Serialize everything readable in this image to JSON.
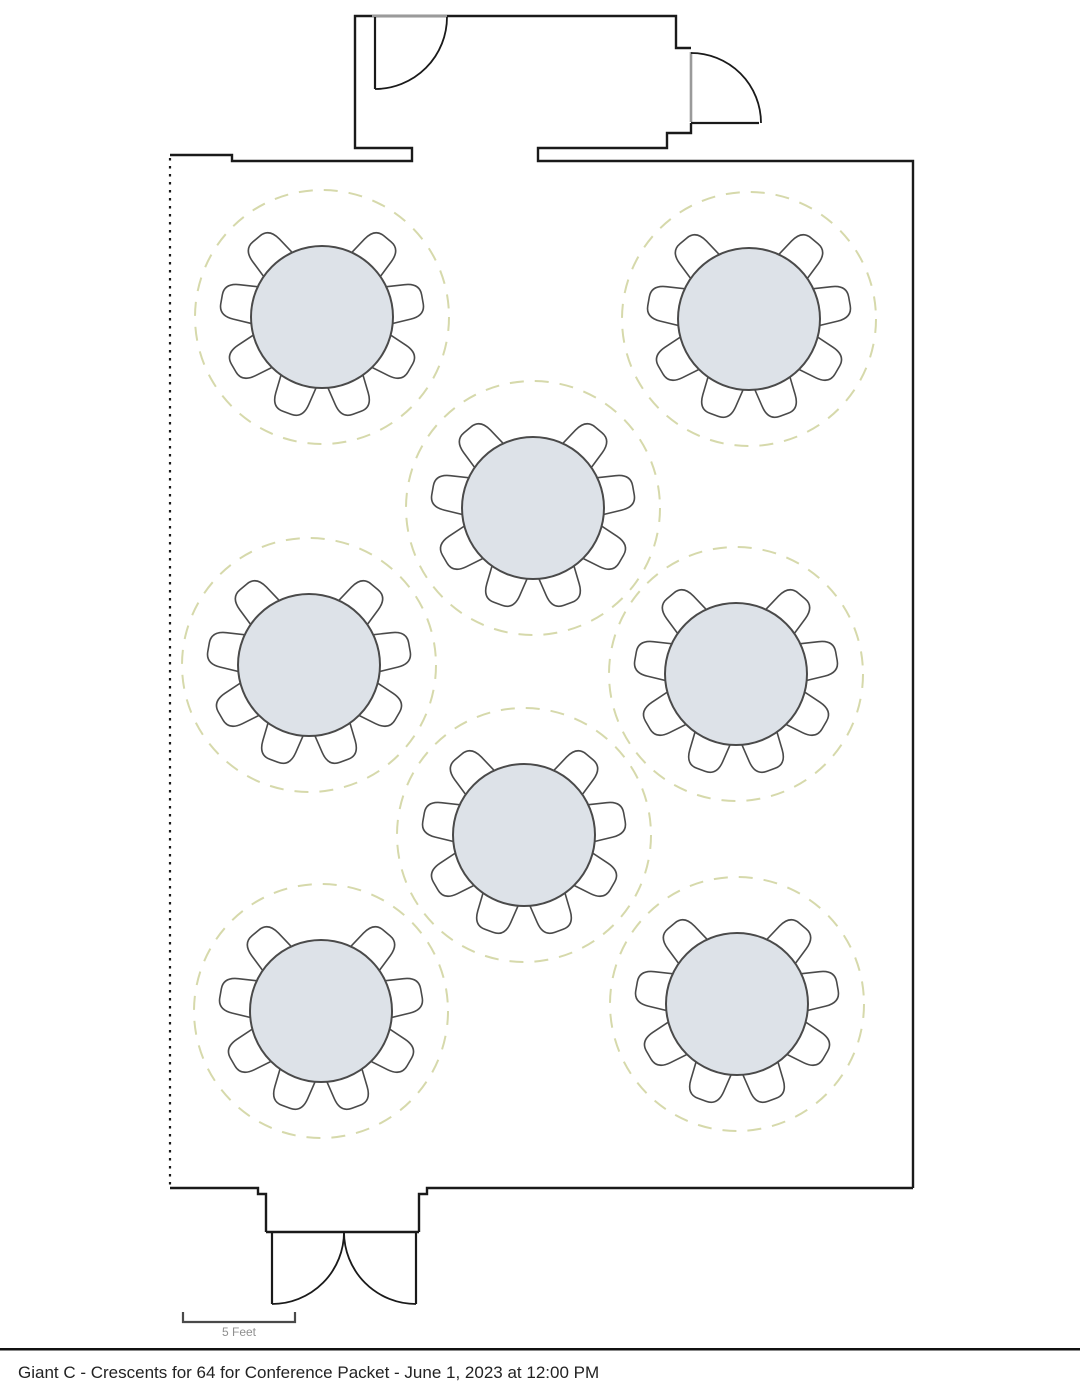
{
  "canvas": {
    "width": 1080,
    "height": 1397,
    "background": "#ffffff"
  },
  "caption": {
    "text": "Giant C - Crescents for 64 for Conference Packet - June 1, 2023 at 12:00 PM"
  },
  "scale_bar": {
    "label": "5 Feet"
  },
  "colors": {
    "wall": "#1a1a1a",
    "doorway_opening": "#9a9a9a",
    "table_fill": "#dde2e8",
    "table_stroke": "#4a4a4a",
    "chair_fill": "#ffffff",
    "chair_stroke": "#4a4a4a",
    "spacing_guide_dash": "#d6d9ab",
    "scale_bar": "#4a4a4a",
    "scale_label": "#8f8f8f",
    "caption_text": "#222222",
    "caption_rule": "#111111"
  },
  "layout_plan": {
    "tables_count": 8,
    "seats_per_table": 8,
    "total_seats": 64,
    "table_radius": 71,
    "guide_radius": 127,
    "chair_angles_deg": [
      -50,
      -10,
      30,
      70,
      110,
      150,
      190,
      230
    ],
    "tables": [
      {
        "id": 1,
        "cx": 322,
        "cy": 317
      },
      {
        "id": 2,
        "cx": 749,
        "cy": 319
      },
      {
        "id": 3,
        "cx": 533,
        "cy": 508
      },
      {
        "id": 4,
        "cx": 309,
        "cy": 665
      },
      {
        "id": 5,
        "cx": 736,
        "cy": 674
      },
      {
        "id": 6,
        "cx": 524,
        "cy": 835
      },
      {
        "id": 7,
        "cx": 321,
        "cy": 1011
      },
      {
        "id": 8,
        "cx": 737,
        "cy": 1004
      }
    ]
  }
}
